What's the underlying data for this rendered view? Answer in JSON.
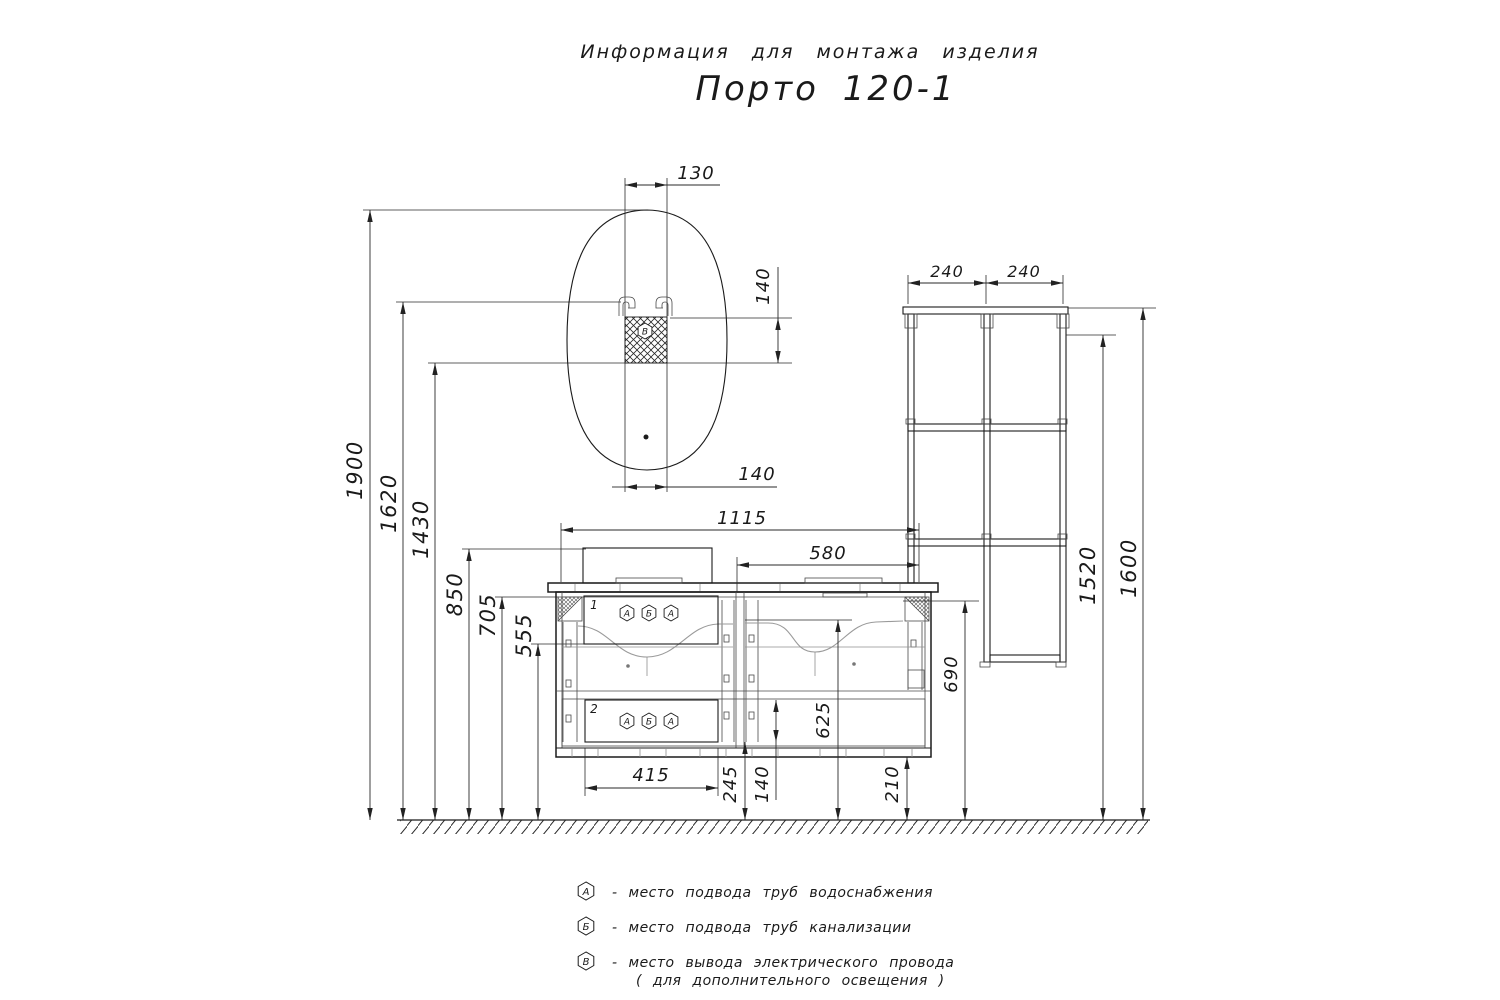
{
  "header": {
    "title": "Информация для монтажа изделия",
    "subtitle": "Порто 120-1"
  },
  "dims": {
    "d130": "130",
    "d140_outlet": "140",
    "d140_bottom": "140",
    "d1900": "1900",
    "d1620": "1620",
    "d1430": "1430",
    "d850": "850",
    "d705": "705",
    "d555": "555",
    "d1115": "1115",
    "d580": "580",
    "d415": "415",
    "d245": "245",
    "d140_niche": "140",
    "d625": "625",
    "d690": "690",
    "d210": "210",
    "d240a": "240",
    "d240b": "240",
    "d1520": "1520",
    "d1600": "1600"
  },
  "callouts": {
    "top": "1",
    "bottom": "2"
  },
  "symbols": {
    "water": "А",
    "sewer": "Б",
    "electric": "В"
  },
  "legend": {
    "items": [
      {
        "symbol": "А",
        "text": "-  место подвода труб водоснабжения"
      },
      {
        "symbol": "Б",
        "text": "-  место подвода труб канализации"
      },
      {
        "symbol": "В",
        "text": "-  место вывода электрического провода",
        "text2": "( для дополнительного освещения )"
      }
    ]
  }
}
